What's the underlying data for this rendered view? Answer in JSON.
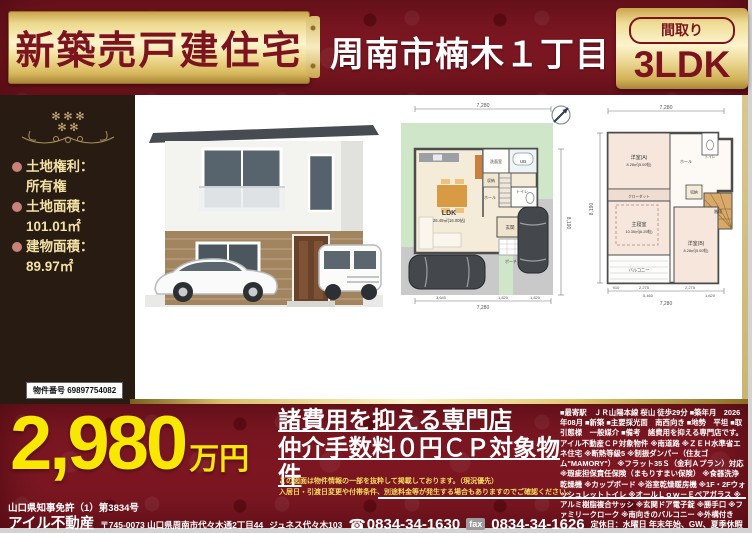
{
  "colors": {
    "dark_red": "#7c1722",
    "gold": "#ecd88e",
    "price_yellow": "#f8e700",
    "sidebar_brown": "#281b12"
  },
  "header": {
    "ribbon_title": "新築売戸建住宅",
    "location": "周南市楠木１丁目",
    "madori_label": "間取り",
    "madori_value": "3LDK"
  },
  "sidebar": {
    "items": [
      {
        "label": "土地権利：",
        "value": "所有権"
      },
      {
        "label": "土地面積：",
        "value": "101.01㎡"
      },
      {
        "label": "建物面積：",
        "value": "89.97㎡"
      }
    ],
    "property_number": "物件番号 69897754082"
  },
  "fp1": {
    "ldk": "LDK",
    "ldk_size": "26.49㎡(16.00帖)",
    "wash": "洗面室",
    "bath": "UB",
    "toilet": "トイレ",
    "storage": "収納",
    "hall": "ホール",
    "entrance": "玄関",
    "porch": "ポーチ",
    "dim_top": "7,280",
    "dim_bottom_subs": [
      "3,640",
      "1,820",
      "1,820"
    ],
    "dim_bottom_total": "7,280",
    "dim_side": "8,190"
  },
  "fp2": {
    "room_a": "洋室(A)",
    "room_a_size": "8.28㎡(5.00帖)",
    "master": "主寝室",
    "master_size": "10.35㎡(6.25帖)",
    "room_b": "洋室(B)",
    "room_b_size": "8.28㎡(5.00帖)",
    "balcony": "バルコニー",
    "stairs": "階段",
    "closet": "クローゼット",
    "hall": "ホール",
    "toilet": "トイレ",
    "storage": "収納",
    "dim_top": "7,280",
    "dim_bottom_subs": [
      "910",
      "2,275",
      "2,275"
    ],
    "dim_bottom_mid": [
      "5,460",
      "1,820"
    ],
    "dim_bottom_total": "7,280",
    "dim_side": "8,190"
  },
  "price": {
    "amount": "2,980",
    "unit": "万円"
  },
  "promo": {
    "headline1": "諸費用を抑える専門店",
    "headline2": "仲介手数料０円ＣＰ対象物件",
    "disclaimer1": "この図面は物件情報の一部を抜粋して掲載しております。（現況優先）",
    "disclaimer2": "入居日・引渡日変更や付帯条件、別途料金等が発生する場合もありますのでご確認ください。",
    "features": "■最寄駅　ＪＲ山陽本線 桜山 徒歩29分 ■築年月　2026年08月 ■新築 ■主要採光面　南西向き ■地勢　平坦 ■取引態様　一般媒介 ■備考　諸費用を抑える専門店です。アイル不動産ＣＰ対象物件 ※南道路 ※ＺＥＨ水準省エネ住宅 ※断熱等級5 ※制振ダンパー（住友ゴム\"MAMORY\"） ※フラット35Ｓ（金利Ａプラン）対応 ※瑕疵担保責任保険（まもりすまい保険） ※食器洗浄乾燥機 ※カップボード ※浴室乾燥暖房機 ※1F・2Fウォッシュレットトイレ ※オールＬｏｗ－Ｅペアガラス ※アルミ樹脂複合サッシ ※玄関ドア電子錠 ※勝手口 ※ファミリークローク ※南向きのバルコニー ※外構付き"
  },
  "footer": {
    "license": "山口県知事免許（1）第3834号",
    "company": "アイル不動産",
    "address": "〒745-0073 山口県周南市代々木通2丁目44",
    "address2": "ジュネス代々木103",
    "tel_icon": "☎",
    "tel": "0834-34-1630",
    "fax_label": "fax",
    "fax": "0834-34-1626",
    "holidays": "定休日：水曜日 年末年始、GW、夏季休暇"
  }
}
